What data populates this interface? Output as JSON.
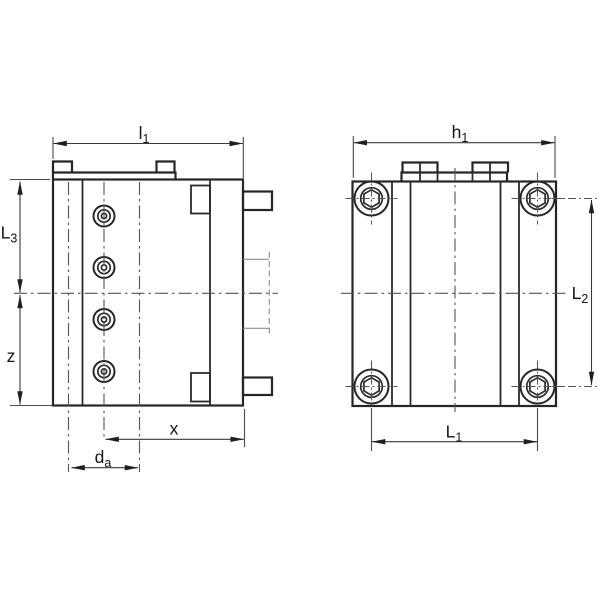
{
  "figure": {
    "kind": "dimension-drawing",
    "colors": {
      "background": "#ffffff",
      "outline": "#262626",
      "dimension_line": "#4a4a4a",
      "center_line": "#555555",
      "hidden_line": "#8c8c8c",
      "text": "#151515"
    },
    "labels": {
      "l1": {
        "main": "l",
        "sub": "1"
      },
      "h1": {
        "main": "h",
        "sub": "1"
      },
      "L3": {
        "main": "L",
        "sub": "3"
      },
      "z": {
        "main": "z",
        "sub": ""
      },
      "x": {
        "main": "x",
        "sub": ""
      },
      "da": {
        "main": "d",
        "sub": "a"
      },
      "L2": {
        "main": "L",
        "sub": "2"
      },
      "L1": {
        "main": "L",
        "sub": "1"
      }
    }
  }
}
